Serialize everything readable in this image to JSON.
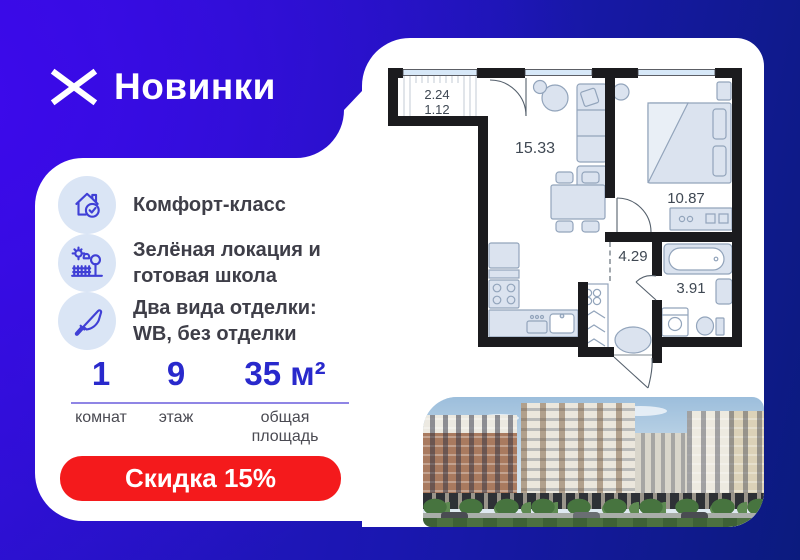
{
  "brand": {
    "name": "Новинки"
  },
  "features": {
    "items": [
      {
        "icon": "house-check-icon",
        "text": "Комфорт-класс"
      },
      {
        "icon": "park-icon",
        "text": "Зелёная локация и готовая школа"
      },
      {
        "icon": "trowel-icon",
        "text": "Два вида отделки: WB, без отделки"
      }
    ]
  },
  "stats": {
    "items": [
      {
        "value": "1",
        "label": "комнат"
      },
      {
        "value": "9",
        "label": "этаж"
      },
      {
        "value": "35 м²",
        "label": "общая площадь"
      }
    ]
  },
  "discount": {
    "label": "Скидка 15%"
  },
  "floor_plan": {
    "balcony_area_total": "2.24",
    "balcony_area_counted": "1.12",
    "living_kitchen_area": "15.33",
    "bedroom_area": "10.87",
    "hallway_area": "4.29",
    "bathroom_area": "3.91"
  },
  "colors": {
    "brand_blue": "#3A0DE6",
    "dark_navy": "#0B1B7E",
    "stat_number_blue": "#2929CC",
    "stat_line_violet": "#8F85E5",
    "discount_red": "#F41A1C",
    "icon_indigo": "#4040D6",
    "icon_circle_bg": "#DAE5F5"
  }
}
